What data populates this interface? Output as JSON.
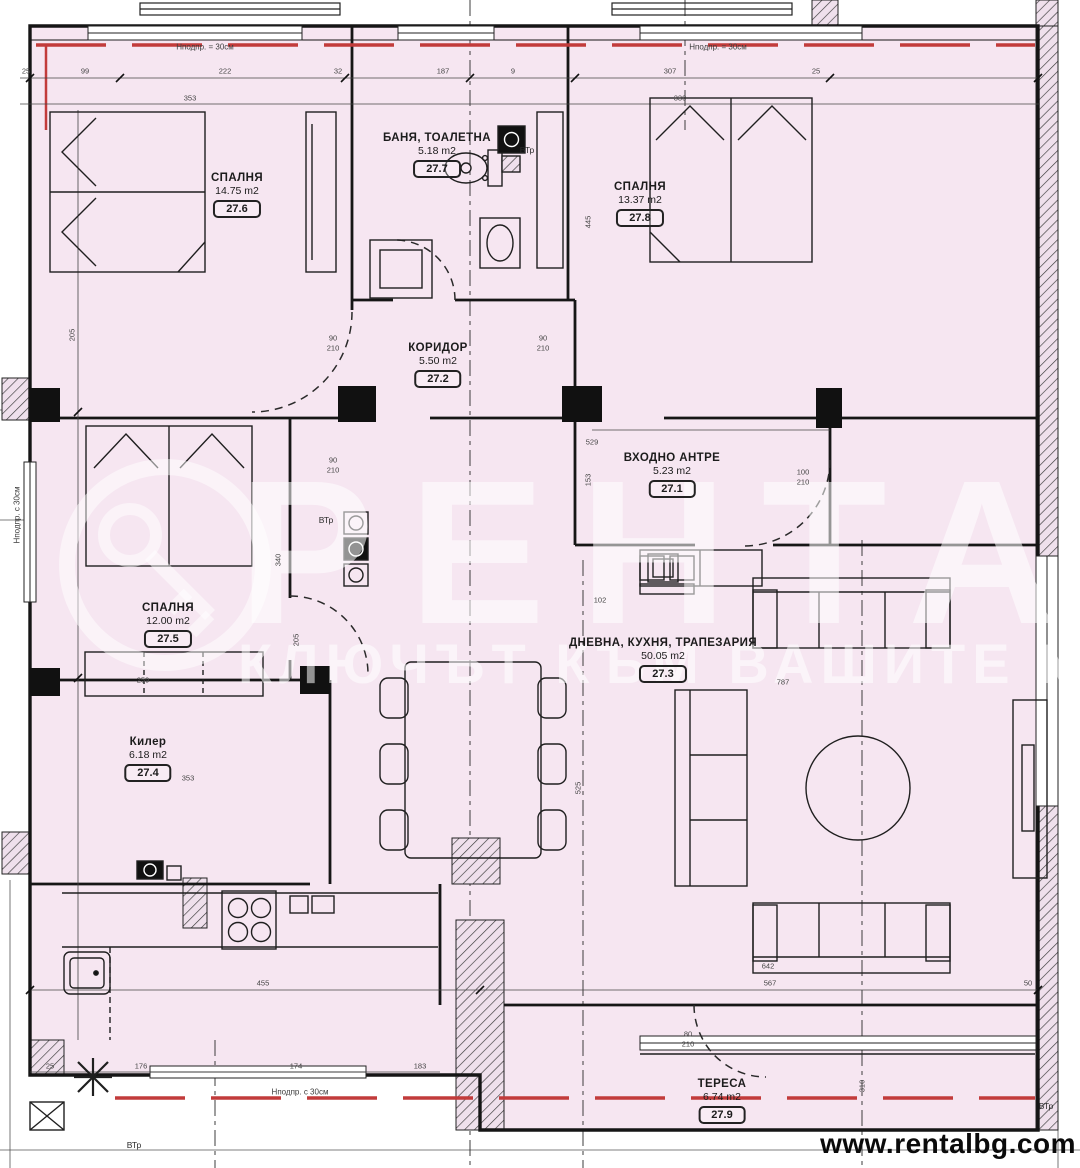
{
  "branding": {
    "url": "www.rentalbg.com",
    "watermark_title": "РЕНТАЛ",
    "watermark_subtitle": "КЛЮЧЪТ КЪМ ВАШИТЕ МЕЧТИ"
  },
  "colors": {
    "plan_fill": "#f6e6f1",
    "line": "#1a1a1a",
    "red": "#c23b3b",
    "dim_text": "#454545"
  },
  "rooms": [
    {
      "id": "bedroom-1",
      "name": "СПАЛНЯ",
      "area": "14.75 m2",
      "tag": "27.6",
      "x": 237,
      "y": 172
    },
    {
      "id": "bathroom",
      "name": "БАНЯ, ТОАЛЕТНА",
      "area": "5.18 m2",
      "tag": "27.7",
      "x": 437,
      "y": 132
    },
    {
      "id": "bedroom-2",
      "name": "СПАЛНЯ",
      "area": "13.37 m2",
      "tag": "27.8",
      "x": 640,
      "y": 181
    },
    {
      "id": "corridor",
      "name": "КОРИДОР",
      "area": "5.50 m2",
      "tag": "27.2",
      "x": 438,
      "y": 342
    },
    {
      "id": "entry-hall",
      "name": "ВХОДНО АНТРЕ",
      "area": "5.23 m2",
      "tag": "27.1",
      "x": 672,
      "y": 452
    },
    {
      "id": "bedroom-3",
      "name": "СПАЛНЯ",
      "area": "12.00 m2",
      "tag": "27.5",
      "x": 168,
      "y": 602
    },
    {
      "id": "living-kitchen-dining",
      "name": "ДНЕВНА, КУХНЯ, ТРАПЕЗАРИЯ",
      "area": "50.05 m2",
      "tag": "27.3",
      "x": 663,
      "y": 637
    },
    {
      "id": "closet",
      "name": "Килер",
      "area": "6.18 m2",
      "tag": "27.4",
      "x": 148,
      "y": 736
    },
    {
      "id": "terrace",
      "name": "ТЕРЕСА",
      "area": "6.74 m2",
      "tag": "27.9",
      "x": 722,
      "y": 1078
    }
  ],
  "annotations": [
    {
      "t": "Нподпр. = 30см",
      "x": 205,
      "y": 47
    },
    {
      "t": "Нподпр. = 30см",
      "x": 718,
      "y": 47
    },
    {
      "t": "Нподпр. с 30см",
      "x": 300,
      "y": 1092
    },
    {
      "t": "Нподпр. с 30см",
      "x": 17,
      "y": 515,
      "r": 1
    }
  ],
  "vtr_labels": [
    {
      "t": "ВТр",
      "x": 326,
      "y": 520
    },
    {
      "t": "ВТр",
      "x": 527,
      "y": 150
    },
    {
      "t": "ВТр",
      "x": 134,
      "y": 1145
    },
    {
      "t": "ВТр",
      "x": 1046,
      "y": 1106
    }
  ],
  "dimensions": [
    {
      "t": "25",
      "x": 26,
      "y": 71
    },
    {
      "t": "99",
      "x": 85,
      "y": 71
    },
    {
      "t": "222",
      "x": 225,
      "y": 71
    },
    {
      "t": "32",
      "x": 338,
      "y": 71
    },
    {
      "t": "187",
      "x": 443,
      "y": 71
    },
    {
      "t": "9",
      "x": 513,
      "y": 71
    },
    {
      "t": "307",
      "x": 670,
      "y": 71
    },
    {
      "t": "25",
      "x": 816,
      "y": 71
    },
    {
      "t": "353",
      "x": 190,
      "y": 98
    },
    {
      "t": "330",
      "x": 680,
      "y": 98
    },
    {
      "t": "529",
      "x": 592,
      "y": 442
    },
    {
      "t": "102",
      "x": 600,
      "y": 600
    },
    {
      "t": "787",
      "x": 783,
      "y": 682
    },
    {
      "t": "259",
      "x": 143,
      "y": 680
    },
    {
      "t": "353",
      "x": 188,
      "y": 778
    },
    {
      "t": "445",
      "x": 588,
      "y": 222,
      "r": 1
    },
    {
      "t": "340",
      "x": 278,
      "y": 560,
      "r": 1
    },
    {
      "t": "205",
      "x": 296,
      "y": 640,
      "r": 1
    },
    {
      "t": "525",
      "x": 578,
      "y": 788,
      "r": 1
    },
    {
      "t": "153",
      "x": 588,
      "y": 480,
      "r": 1
    },
    {
      "t": "310",
      "x": 862,
      "y": 1086,
      "r": 1
    },
    {
      "t": "205",
      "x": 72,
      "y": 335,
      "r": 1
    },
    {
      "t": "90",
      "x": 333,
      "y": 338
    },
    {
      "t": "210",
      "x": 333,
      "y": 348
    },
    {
      "t": "90",
      "x": 543,
      "y": 338
    },
    {
      "t": "210",
      "x": 543,
      "y": 348
    },
    {
      "t": "90",
      "x": 333,
      "y": 460
    },
    {
      "t": "210",
      "x": 333,
      "y": 470
    },
    {
      "t": "100",
      "x": 803,
      "y": 472
    },
    {
      "t": "210",
      "x": 803,
      "y": 482
    },
    {
      "t": "80",
      "x": 688,
      "y": 1034
    },
    {
      "t": "210",
      "x": 688,
      "y": 1044
    },
    {
      "t": "455",
      "x": 263,
      "y": 983
    },
    {
      "t": "567",
      "x": 770,
      "y": 983
    },
    {
      "t": "50",
      "x": 1028,
      "y": 983
    },
    {
      "t": "642",
      "x": 768,
      "y": 966
    },
    {
      "t": "25",
      "x": 50,
      "y": 1066
    },
    {
      "t": "176",
      "x": 141,
      "y": 1066
    },
    {
      "t": "174",
      "x": 296,
      "y": 1066
    },
    {
      "t": "183",
      "x": 420,
      "y": 1066
    }
  ]
}
